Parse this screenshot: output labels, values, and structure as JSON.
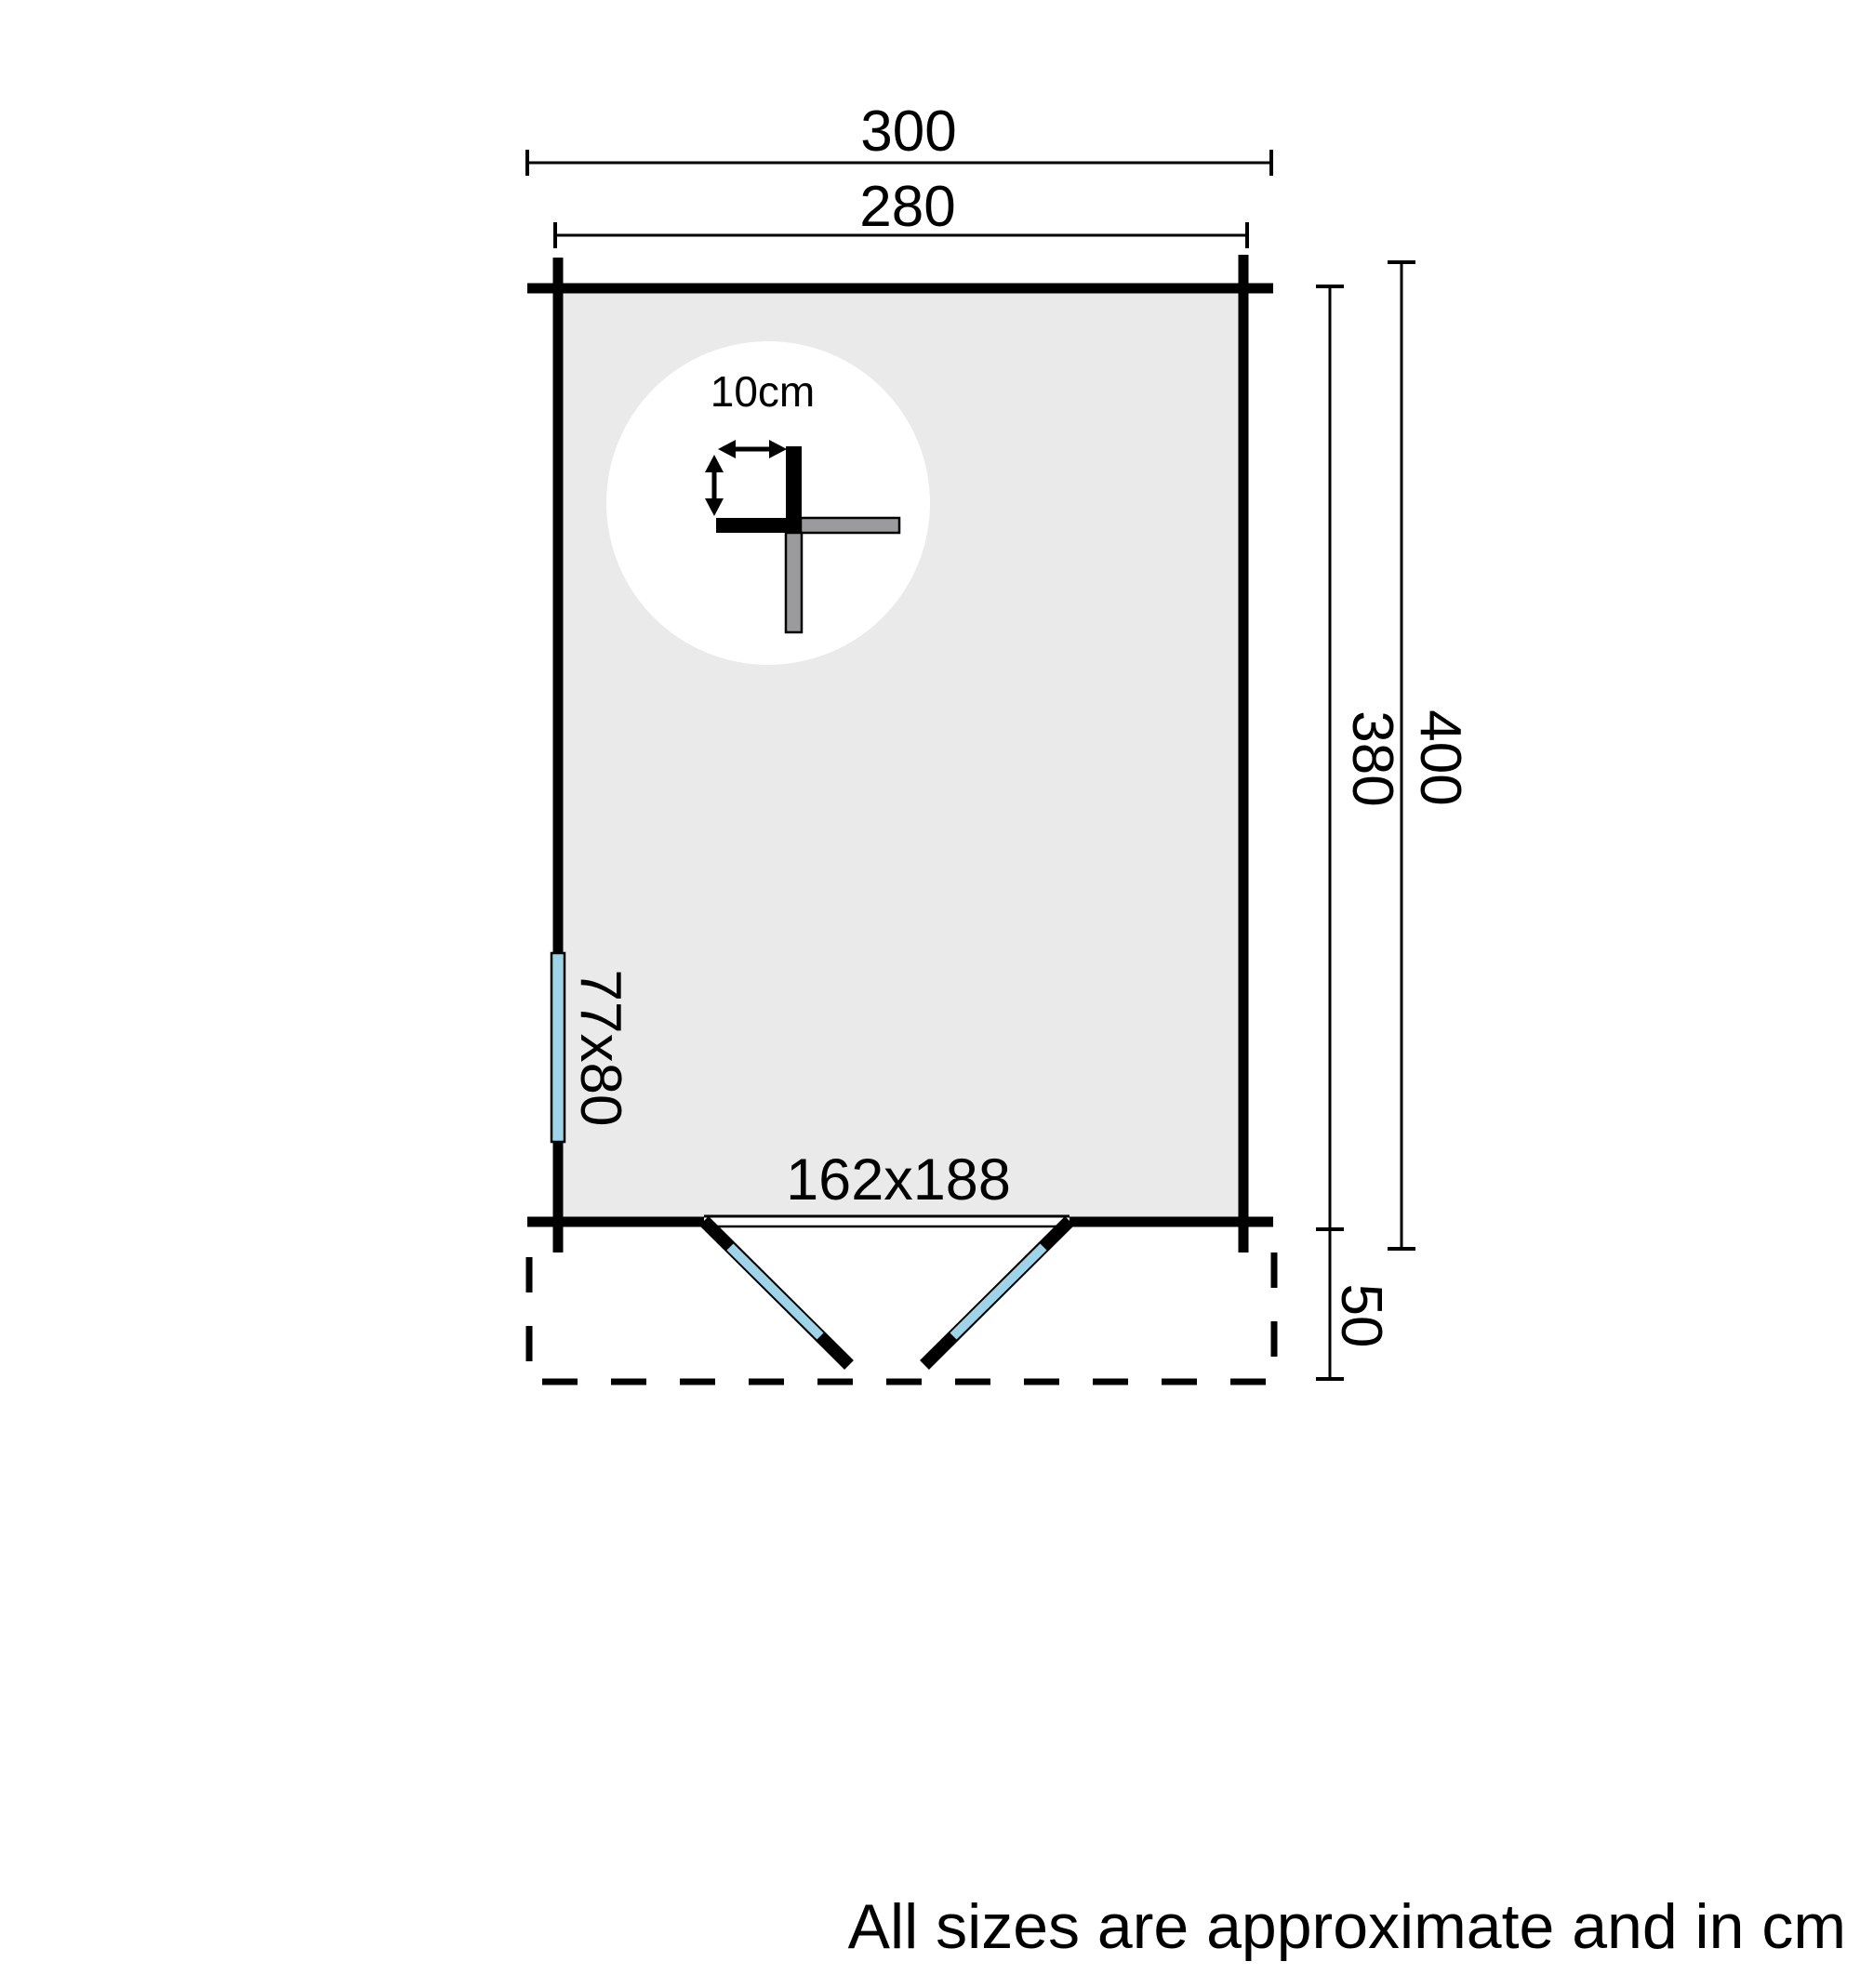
{
  "plan": {
    "labels": {
      "outer_width": "300",
      "inner_width": "280",
      "outer_depth": "400",
      "inner_depth": "380",
      "terrace_depth": "50",
      "door_size": "162x188",
      "window_size": "77x80",
      "log_thickness": "10cm"
    },
    "colors": {
      "glazing": "#9ED3E8",
      "floor": "#EAEAEB",
      "log_gray": "#9B9B9D",
      "circle_bg": "#FFFFFF",
      "ink": "#000000"
    },
    "note": "All sizes are approximate and in cm"
  }
}
